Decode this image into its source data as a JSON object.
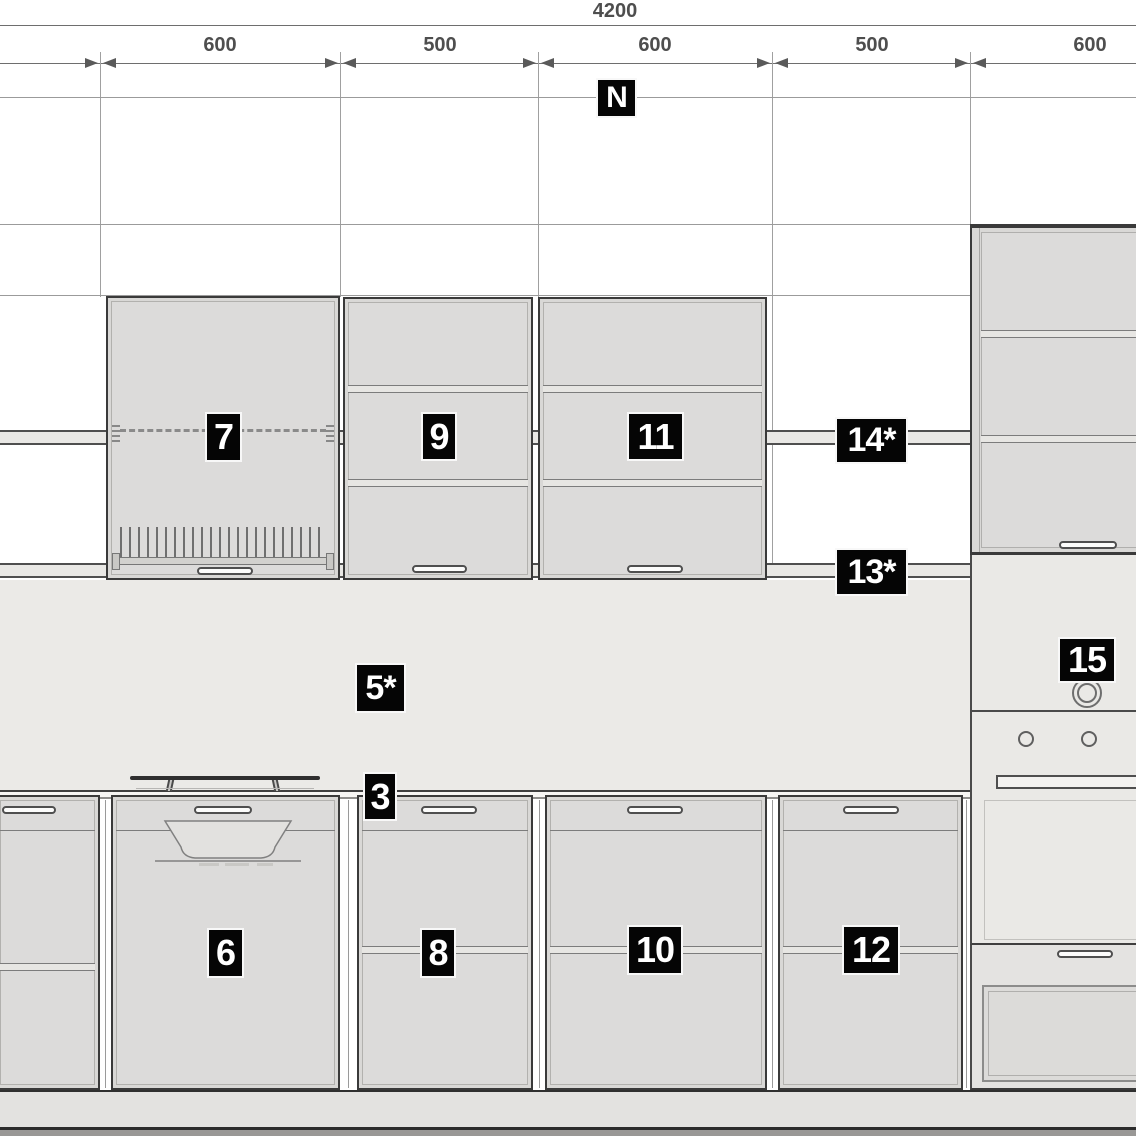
{
  "dimension_bar": {
    "total": "4200",
    "segments": [
      "600",
      "500",
      "600",
      "500",
      "600"
    ]
  },
  "plan_marker": "N",
  "item_labels": {
    "wall_cab_1": "7",
    "wall_cab_2": "9",
    "wall_cab_3": "11",
    "rail_upper": "14*",
    "rail_lower": "13*",
    "backsplash": "5*",
    "countertop": "3",
    "base_cab_1": "6",
    "base_cab_2": "8",
    "base_cab_3": "10",
    "base_cab_4": "12",
    "tall_unit": "15"
  },
  "colors": {
    "label_bg": "#050505",
    "label_text": "#ffffff",
    "cabinet_front": "#d9d8d6",
    "backsplash": "#ebeae7",
    "rail_band": "#e9e8e5",
    "countertop": "#f6f5f3",
    "plinth": "#e3e2e0",
    "floor": "#999896",
    "dimension_text": "#4e4e4e"
  }
}
